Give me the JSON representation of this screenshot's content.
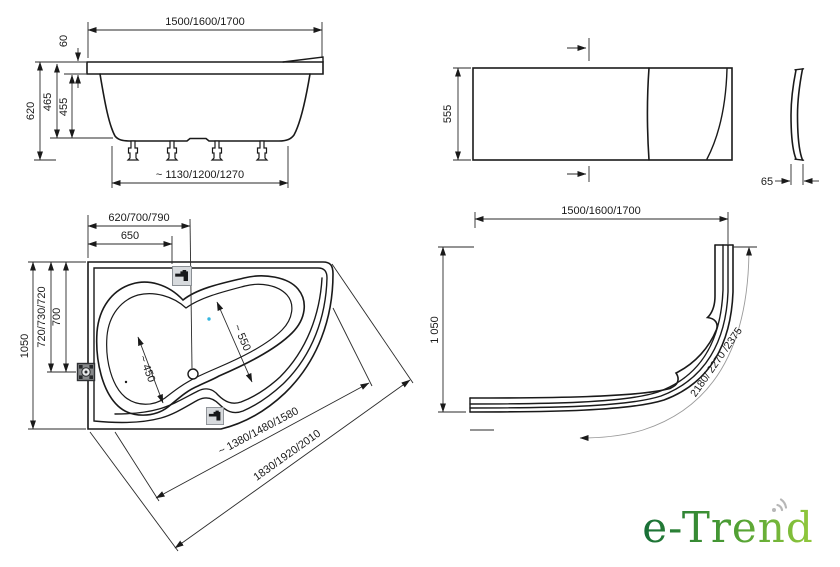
{
  "canvas": {
    "background": "#ffffff",
    "line_color": "#1a1a1a"
  },
  "side_view": {
    "dim_overall_width": "1500/1600/1700",
    "dim_rim_height": "60",
    "dim_depth_with_rim": "465",
    "dim_depth_inner": "455",
    "dim_total_height": "620",
    "dim_base_span": "~ 1130/1200/1270"
  },
  "front_panel_view": {
    "dim_height": "555",
    "dim_edge_depth": "65"
  },
  "plan_view": {
    "dim_corner_to_drain": "620/700/790",
    "dim_corner_to_filler": "650",
    "dim_side_to_jet_variants": "720/730/720",
    "dim_side_to_jet": "700",
    "dim_overall_depth": "1050",
    "dim_bowl_width_left": "~ 450",
    "dim_bowl_width_right": "~ 550",
    "dim_front_edge_diagonal": "~ 1380/1480/1580",
    "dim_overall_diagonal": "1830/1920/2010"
  },
  "apron_view": {
    "dim_overall_width": "1500/1600/1700",
    "dim_overall_depth": "1 050",
    "dim_arc_length": "2180/ 2270 /2375"
  },
  "logo": {
    "text": "e-Trend",
    "gradient_start": "#176e37",
    "gradient_mid": "#4a9c33",
    "gradient_end": "#93c93d",
    "mark_color": "#b7b7b7"
  }
}
